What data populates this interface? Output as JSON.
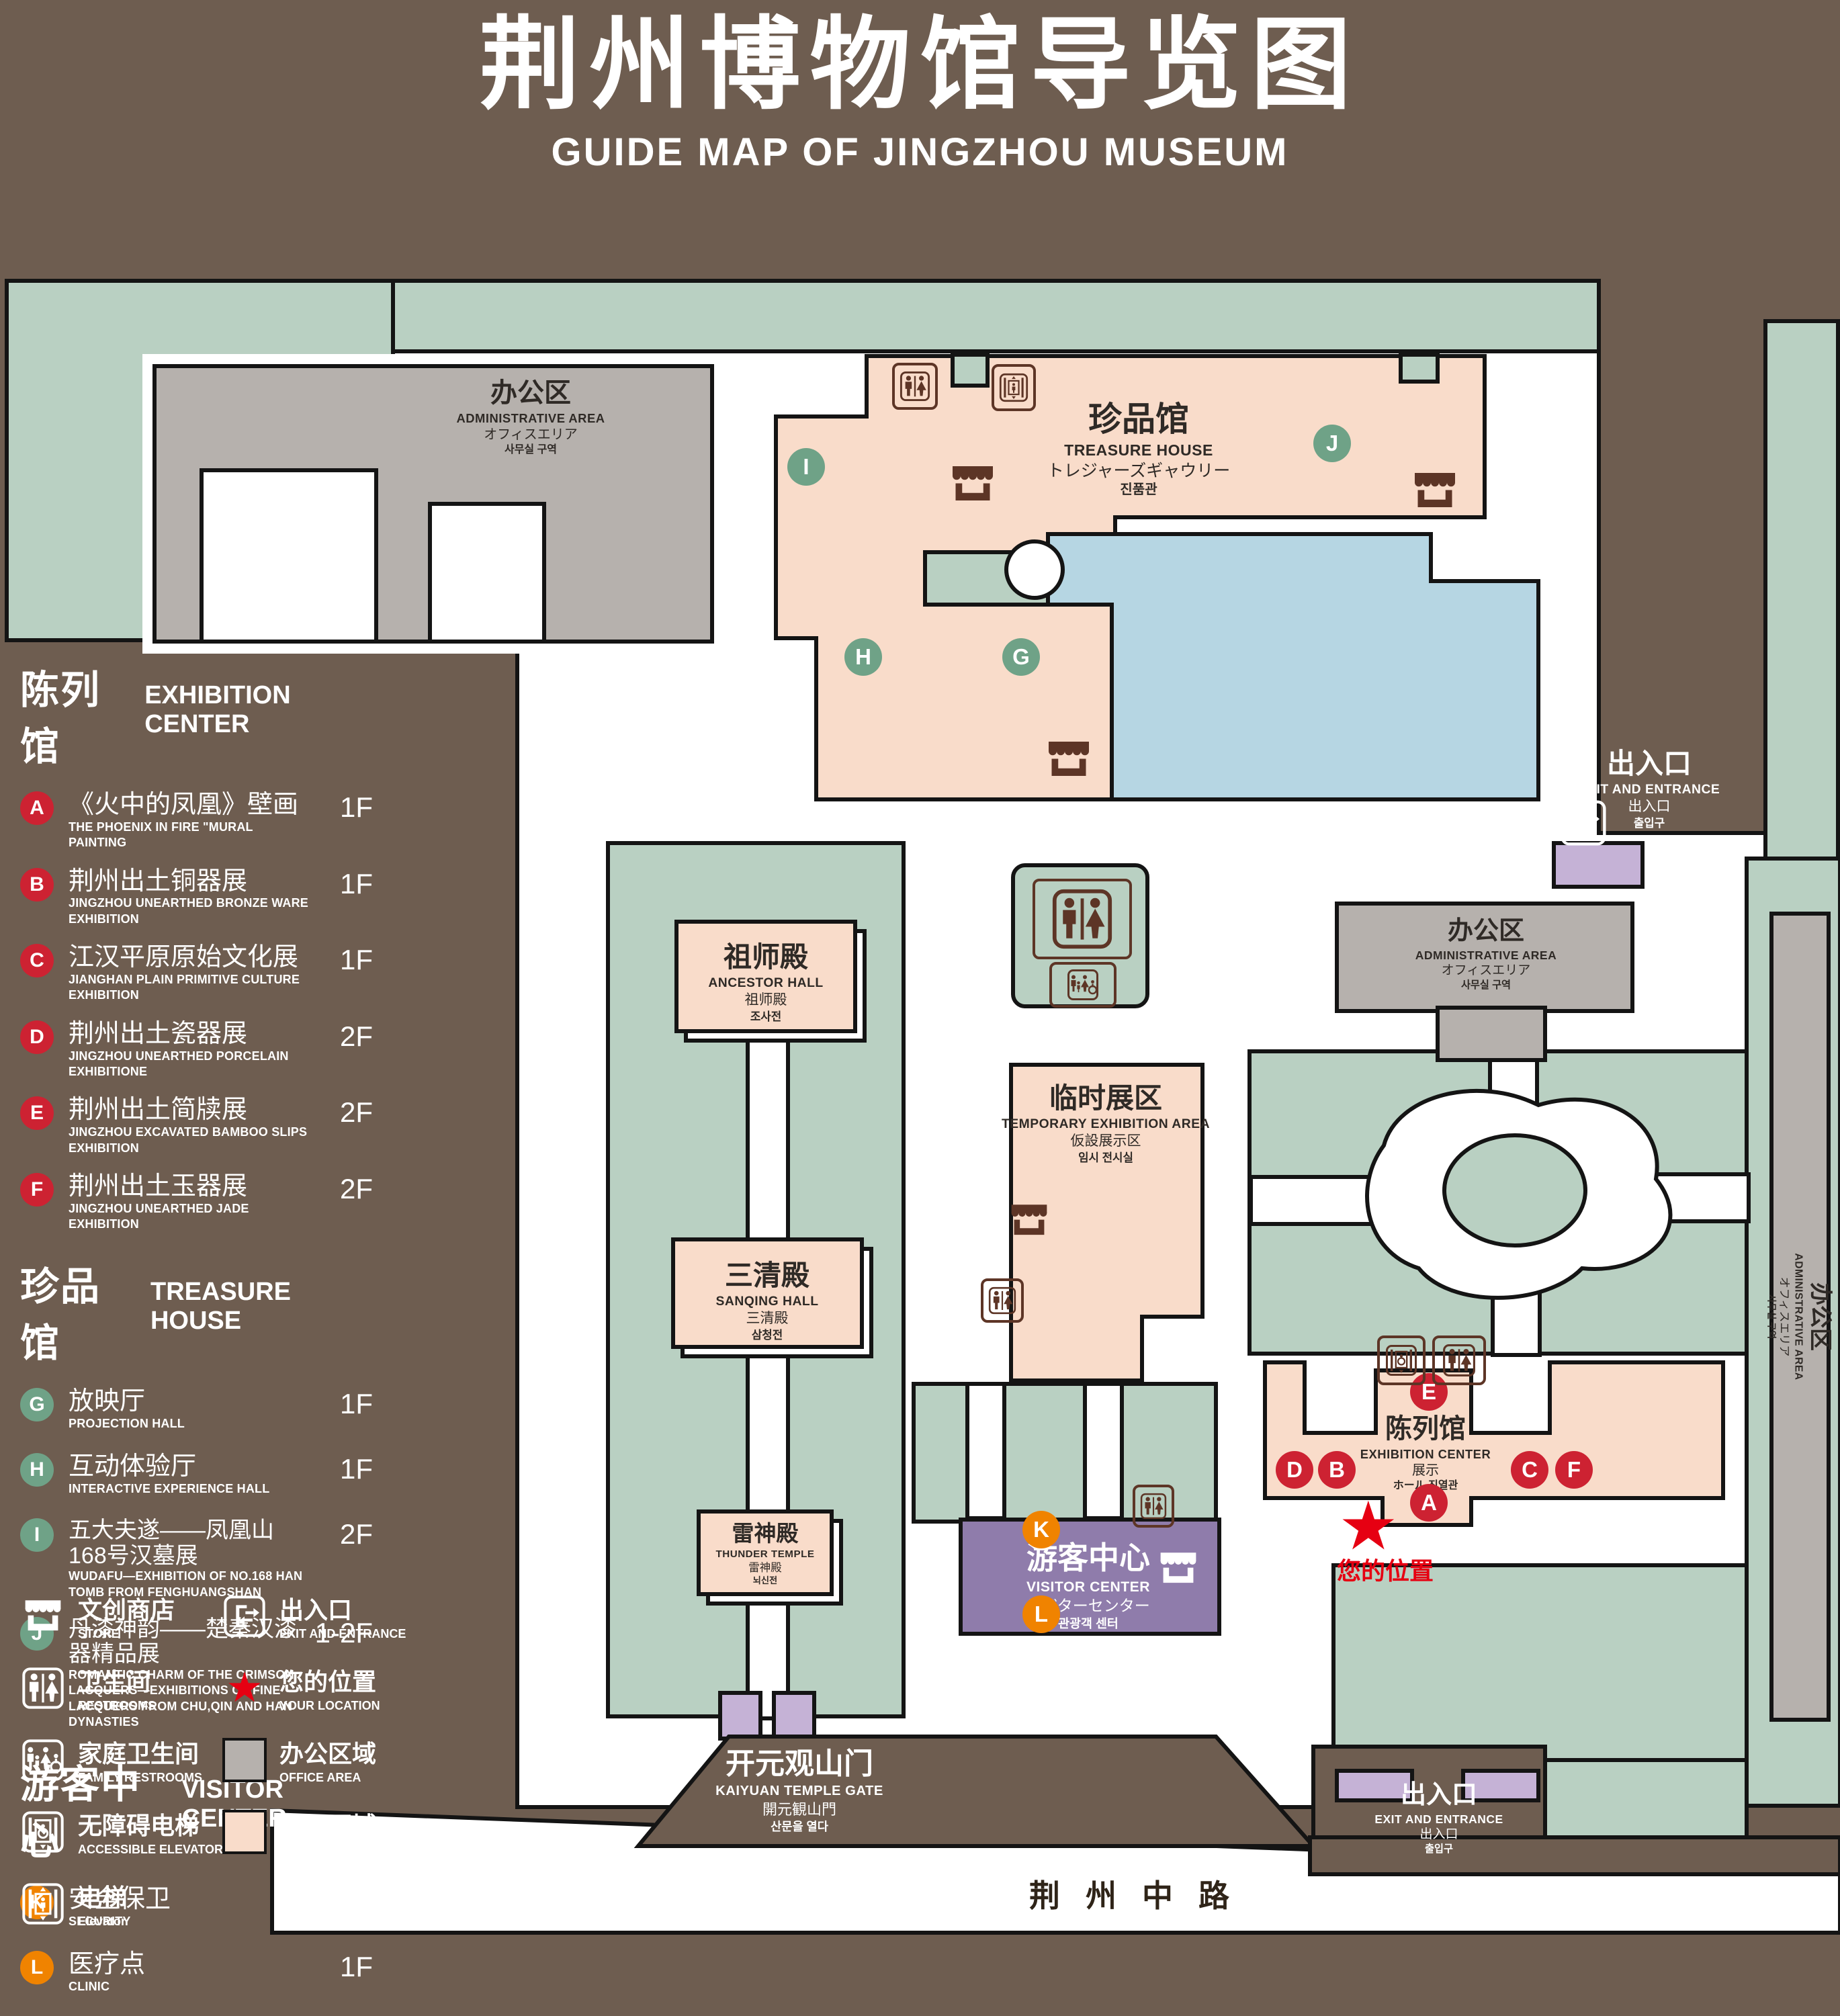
{
  "title": {
    "zh": "荆州博物馆导览图",
    "en": "GUIDE MAP OF JINGZHOU MUSEUM"
  },
  "legend": {
    "sections": [
      {
        "zh": "陈列馆",
        "en": "EXHIBITION CENTER",
        "items": [
          {
            "marker": "A",
            "zh": "《火中的凤凰》壁画",
            "en": "THE PHOENIX IN FIRE \"MURAL PAINTING",
            "floor": "1F"
          },
          {
            "marker": "B",
            "zh": "荆州出土铜器展",
            "en": "JINGZHOU UNEARTHED BRONZE WARE EXHIBITION",
            "floor": "1F"
          },
          {
            "marker": "C",
            "zh": "江汉平原原始文化展",
            "en": "JIANGHAN PLAIN PRIMITIVE CULTURE EXHIBITION",
            "floor": "1F"
          },
          {
            "marker": "D",
            "zh": "荆州出土瓷器展",
            "en": "JINGZHOU UNEARTHED PORCELAIN EXHIBITIONE",
            "floor": "2F"
          },
          {
            "marker": "E",
            "zh": "荆州出土简牍展",
            "en": "JINGZHOU EXCAVATED BAMBOO SLIPS EXHIBITION",
            "floor": "2F"
          },
          {
            "marker": "F",
            "zh": "荆州出土玉器展",
            "en": "JINGZHOU UNEARTHED JADE EXHIBITION",
            "floor": "2F"
          }
        ]
      },
      {
        "zh": "珍品馆",
        "en": "TREASURE HOUSE",
        "items": [
          {
            "marker": "G",
            "zh": "放映厅",
            "en": "PROJECTION HALL",
            "floor": "1F"
          },
          {
            "marker": "H",
            "zh": "互动体验厅",
            "en": "INTERACTIVE EXPERIENCE HALL",
            "floor": "1F"
          },
          {
            "marker": "I",
            "zh": "五大夫遂——凤凰山168号汉墓展",
            "en": "WUDAFU—EXHIBITION OF NO.168 HAN TOMB FROM FENGHUANGSHAN",
            "floor": "2F"
          },
          {
            "marker": "J",
            "zh": "丹漆神韵——楚秦汉漆器精品展",
            "en": "ROMANTIC CHARM OF THE CRIMSON LACQUERS—EXHIBITIONS OF FINE LACQUERS FROM CHU,QIN AND HAN DYNASTIES",
            "floor": "1-2F"
          }
        ]
      },
      {
        "zh": "游客中心",
        "en": "VISITOR CENTER",
        "items": [
          {
            "marker": "K",
            "zh": "安全保卫",
            "en": "SECURITY",
            "floor": "1F"
          },
          {
            "marker": "L",
            "zh": "医疗点",
            "en": "CLINIC",
            "floor": "1F"
          }
        ]
      }
    ]
  },
  "facilities": {
    "store": {
      "zh": "文创商店",
      "en": "STORE"
    },
    "restrooms": {
      "zh": "卫生间",
      "en": "RESTROOMS"
    },
    "family": {
      "zh": "家庭卫生间",
      "en": "FAMILY RESTROOMS"
    },
    "accessible": {
      "zh": "无障碍电梯",
      "en": "ACCESSIBLE ELEVATOR"
    },
    "elevator": {
      "zh": "电梯",
      "en": "Elevator"
    },
    "exit": {
      "zh": "出入口",
      "en": "EXIT AND ENTRANCE"
    },
    "location": {
      "zh": "您的位置",
      "en": "YOUR LOCATION"
    },
    "office": {
      "zh": "办公区域",
      "en": "OFFICE AREA"
    },
    "display": {
      "zh": "展示区域",
      "en": "DISPLAY AREA"
    }
  },
  "map": {
    "admin": {
      "zh": "办公区",
      "en": "ADMINISTRATIVE AREA",
      "jp": "オフィスエリア",
      "kr": "사무실 구역"
    },
    "treasure": {
      "zh": "珍品馆",
      "en": "TREASURE HOUSE",
      "jp": "トレジャーズギャウリー",
      "kr": "진품관"
    },
    "ancestor": {
      "zh": "祖师殿",
      "en": "ANCESTOR HALL",
      "jp": "祖师殿",
      "kr": "조사전"
    },
    "temporary": {
      "zh": "临时展区",
      "en": "TEMPORARY EXHIBITION AREA",
      "jp": "仮設展示区",
      "kr": "임시 전시실"
    },
    "sanqing": {
      "zh": "三清殿",
      "en": "SANQING HALL",
      "jp": "三清殿",
      "kr": "삼청전"
    },
    "thunder": {
      "zh": "雷神殿",
      "en": "THUNDER TEMPLE",
      "jp": "雷神殿",
      "kr": "뇌신전"
    },
    "visitor": {
      "zh": "游客中心",
      "en": "VISITOR CENTER",
      "jp": "ビジターセンター",
      "kr": "관광객 센터"
    },
    "exhibition": {
      "zh": "陈列馆",
      "en": "EXHIBITION CENTER",
      "jp": "展示",
      "kr": "ホール 진열관"
    },
    "gate": {
      "zh": "开元观山门",
      "en": "KAIYUAN TEMPLE GATE",
      "jp": "開元観山門",
      "kr": "산문을 열다"
    },
    "exit": {
      "zh": "出入口",
      "en": "EXIT AND ENTRANCE",
      "jp": "出入口",
      "kr": "출입구"
    },
    "road": "荆州中路",
    "your_location": "您的位置",
    "markers": [
      {
        "letter": "A"
      },
      {
        "letter": "B"
      },
      {
        "letter": "C"
      },
      {
        "letter": "D"
      },
      {
        "letter": "E"
      },
      {
        "letter": "F"
      },
      {
        "letter": "G"
      },
      {
        "letter": "H"
      },
      {
        "letter": "I"
      },
      {
        "letter": "J"
      },
      {
        "letter": "K"
      },
      {
        "letter": "L"
      }
    ]
  },
  "colors": {
    "background": "#6e5d50",
    "green": "#b9d0c2",
    "display_pink": "#f9dcca",
    "office_gray": "#b6b1ad",
    "visitor_purple": "#8f7cab",
    "gate_lavender": "#c5b2d6",
    "pond_blue": "#b6d6e3",
    "marker_red": "#cd2232",
    "marker_green": "#6fa287",
    "marker_orange": "#f08300",
    "icon_brown": "#5d3526",
    "star_red": "#e60012"
  }
}
